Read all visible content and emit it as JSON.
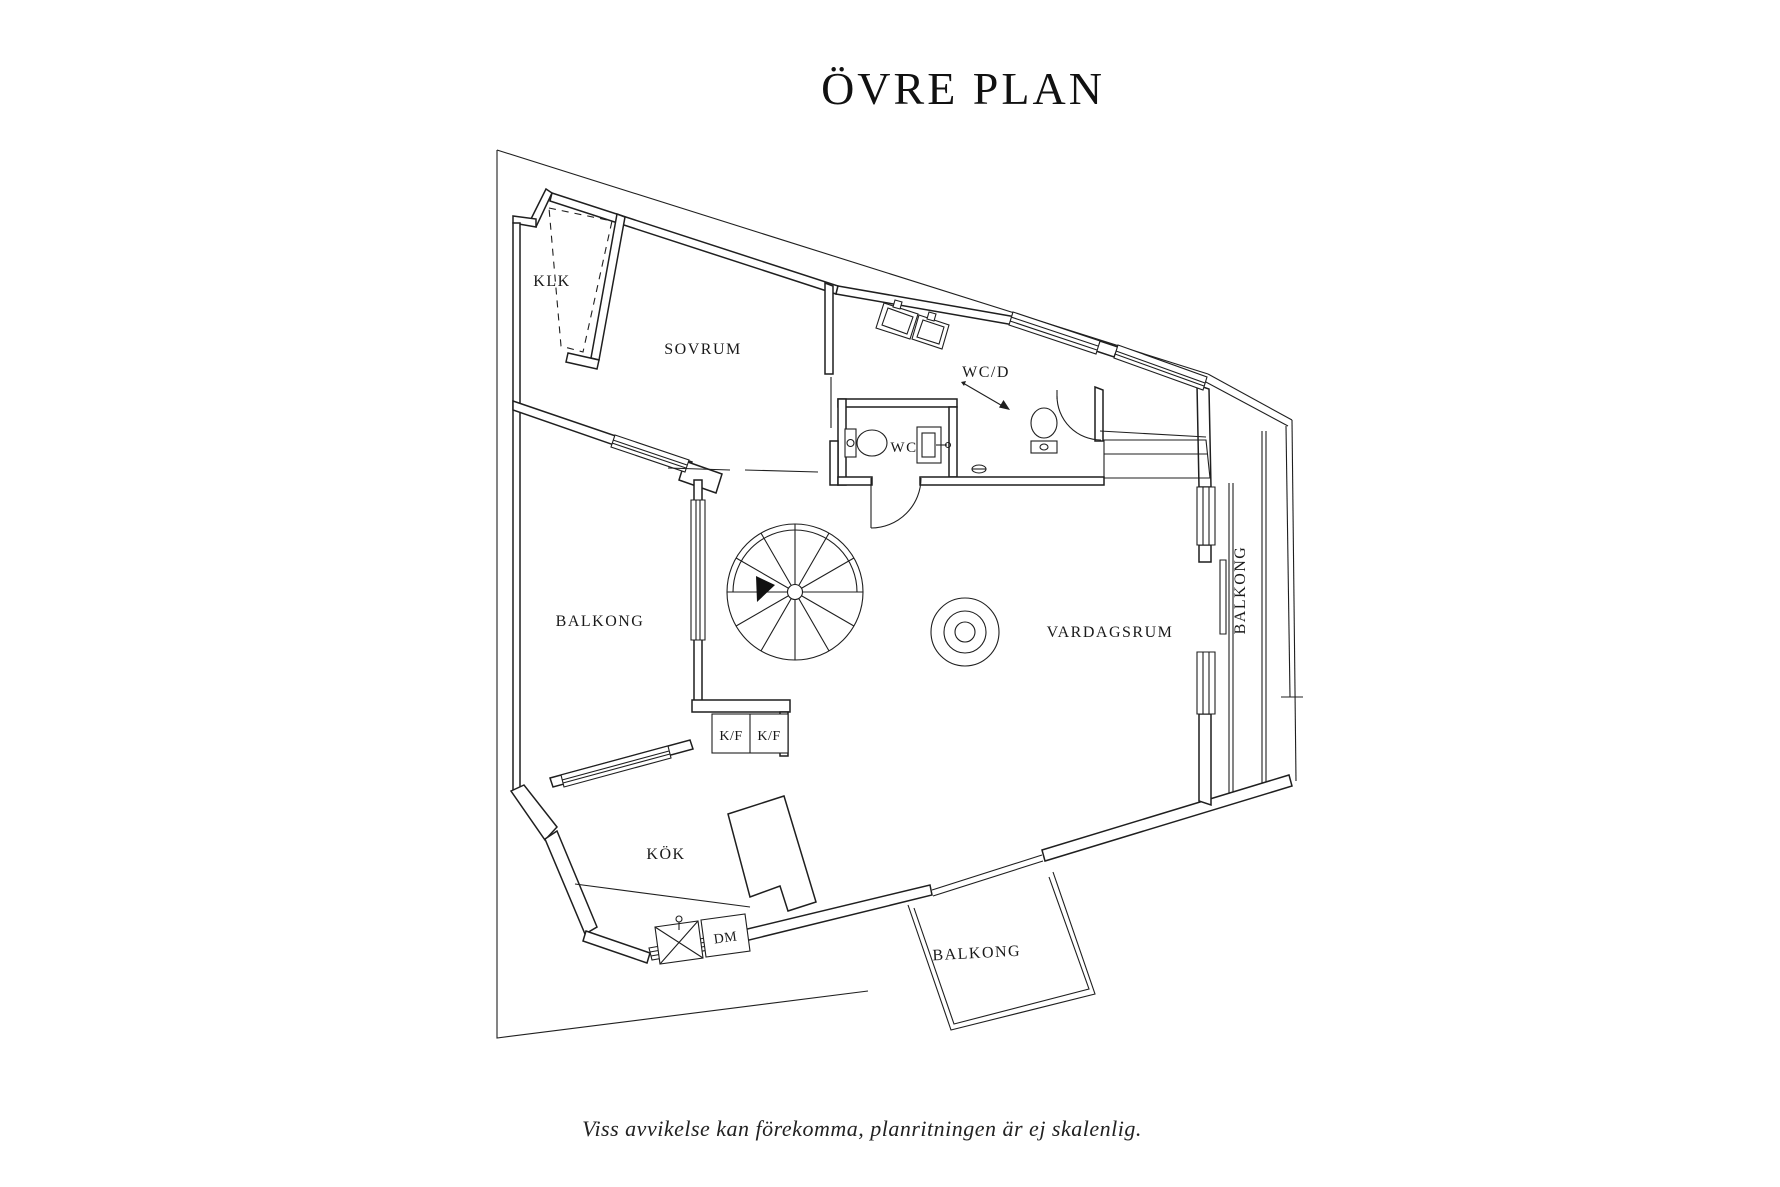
{
  "colors": {
    "background": "#ffffff",
    "line": "#1f1f1f",
    "text": "#1a1a1a"
  },
  "header": {
    "title": "ÖVRE PLAN"
  },
  "rooms": {
    "klk": "KLK",
    "sovrum": "SOVRUM",
    "wcd": "WC/D",
    "wc": "WC",
    "balkong_left": "BALKONG",
    "vardagsrum": "VARDAGSRUM",
    "balkong_right": "BALKONG",
    "kok": "KÖK",
    "balkong_bottom": "BALKONG"
  },
  "fixtures": {
    "fridge_freezer_left": "K/F",
    "fridge_freezer_right": "K/F",
    "dishwasher": "DM"
  },
  "footer": {
    "disclaimer": "Viss avvikelse kan förekomma, planritningen är ej skalenlig."
  }
}
